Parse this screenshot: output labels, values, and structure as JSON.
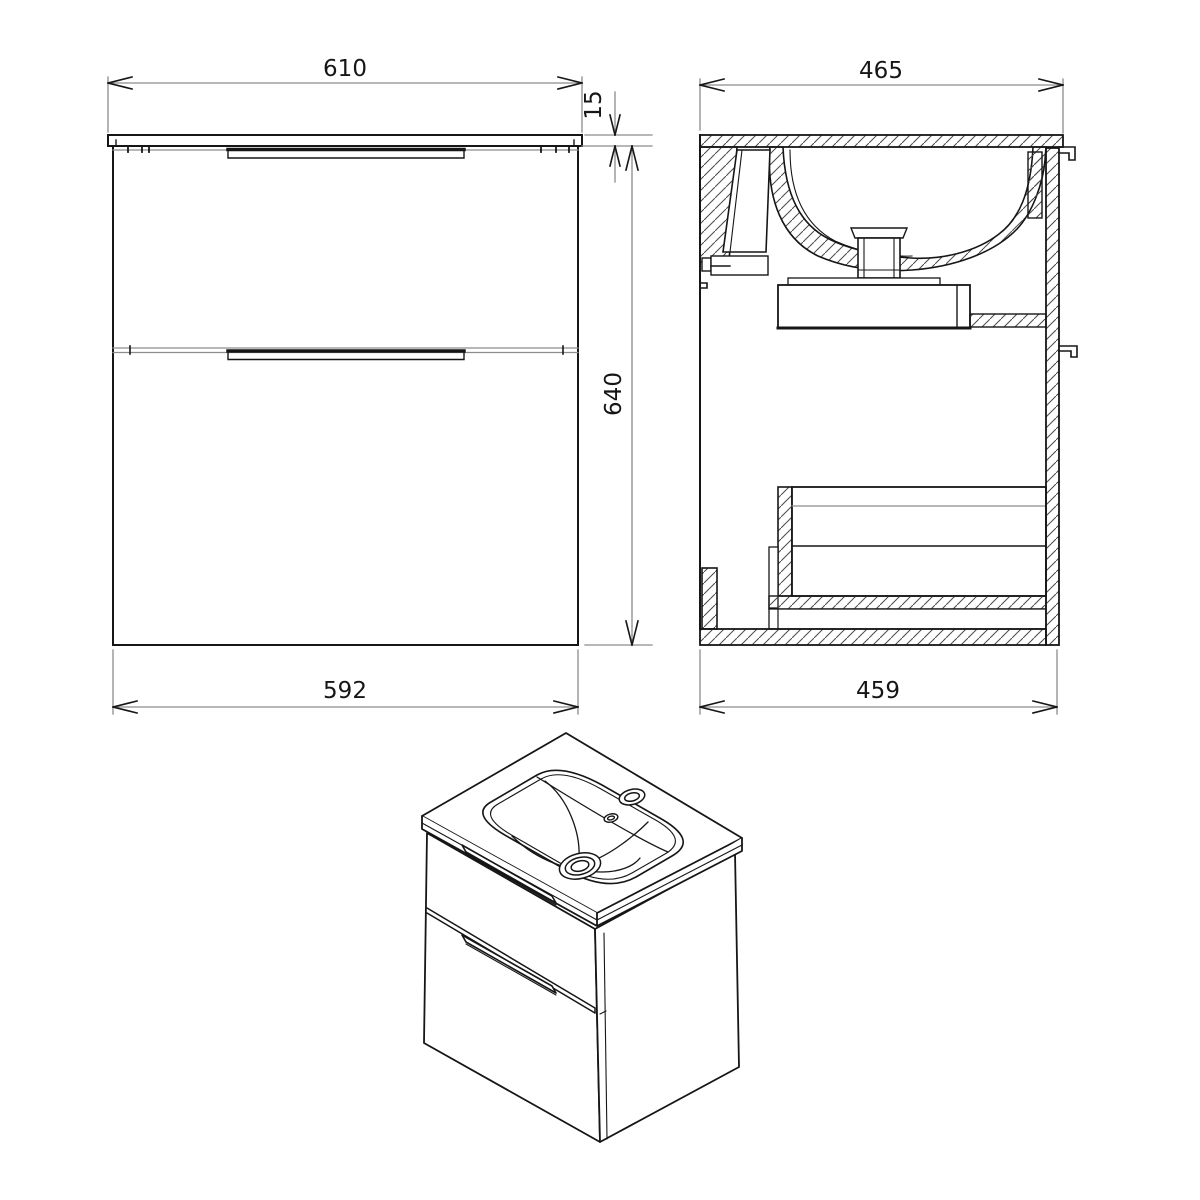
{
  "colors": {
    "background": "#ffffff",
    "line": "#161616",
    "dim_line": "#8c8c8c",
    "hatch": "#4a4a4a"
  },
  "dimensions": {
    "front_top_width": "610",
    "front_top_thickness": "15",
    "front_height": "640",
    "front_body_width": "592",
    "side_top_depth": "465",
    "side_body_depth": "459"
  }
}
